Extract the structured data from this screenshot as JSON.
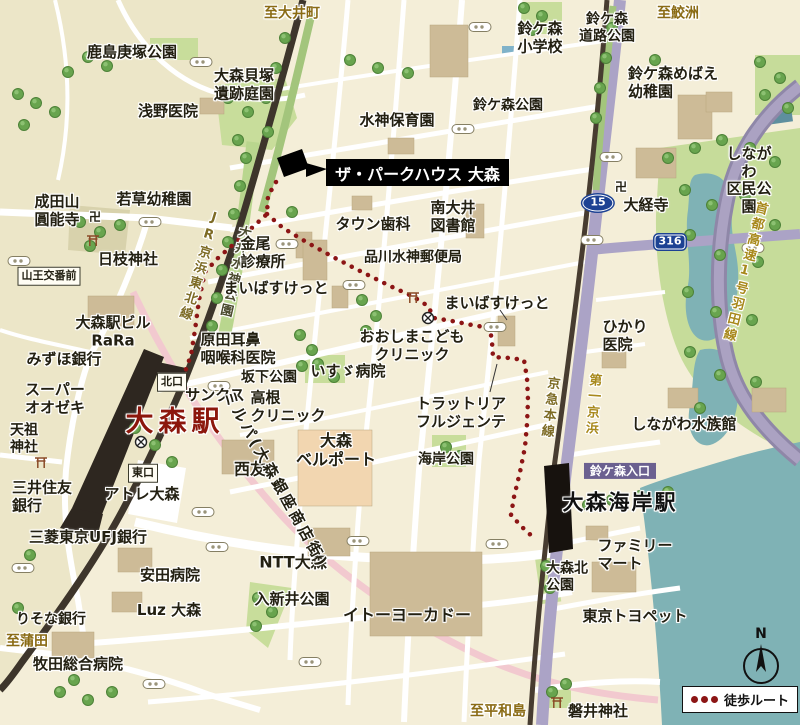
{
  "callout": {
    "text": "ザ・パークハウス 大森"
  },
  "legend": {
    "label": "徒歩ルート"
  },
  "compass": {
    "north": "N"
  },
  "colors": {
    "route_red": "#8C1515",
    "rail": "#3D352B",
    "road_purple": "#ABA3C6",
    "water": "#7FB2B5",
    "park_green": "#C8DD9B",
    "background": "#F4EED8",
    "property_black": "#000000",
    "station_red": "#8C170C"
  },
  "labels": [
    {
      "n": "dir-oimachi",
      "t": "至大井町",
      "x": 292,
      "y": 14,
      "c": "brown"
    },
    {
      "n": "kashima-kozuka-park",
      "t": "鹿島庚塚公園",
      "x": 132,
      "y": 53,
      "c": "s15"
    },
    {
      "n": "omori-kaizuka-garden",
      "t": "大森貝塚\n遺跡庭園",
      "x": 244,
      "y": 85,
      "c": "s15"
    },
    {
      "n": "asano-clinic",
      "t": "浅野医院",
      "x": 168,
      "y": 112,
      "c": "s15"
    },
    {
      "n": "suzugamori-elementary",
      "t": "鈴ケ森\n小学校",
      "x": 540,
      "y": 38,
      "c": "s15"
    },
    {
      "n": "suzugamori-road-park",
      "t": "鈴ケ森\n道路公園",
      "x": 607,
      "y": 28,
      "c": "s14"
    },
    {
      "n": "dir-samezu",
      "t": "至鮫洲",
      "x": 678,
      "y": 14,
      "c": "brown"
    },
    {
      "n": "suzugamori-park",
      "t": "鈴ケ森公園",
      "x": 508,
      "y": 106,
      "c": "s14"
    },
    {
      "n": "suijin-nursery",
      "t": "水神保育園",
      "x": 397,
      "y": 121,
      "c": "s15"
    },
    {
      "n": "suzugamori-mebae-kindergarten",
      "t": "鈴ケ森めばえ\n幼稚園",
      "x": 673,
      "y": 83,
      "c": "left s15"
    },
    {
      "n": "shinagawa-kumin-park",
      "t": "しながわ\n区民公園",
      "x": 749,
      "y": 181,
      "c": "s15"
    },
    {
      "n": "manji-daikyoji-icon",
      "t": "卍",
      "x": 621,
      "y": 187,
      "c": "s12"
    },
    {
      "n": "daikyoji-temple",
      "t": "大経寺",
      "x": 646,
      "y": 206,
      "c": "s15"
    },
    {
      "n": "route-15-shield",
      "t": "15",
      "x": 598,
      "y": 203,
      "c": "shield15"
    },
    {
      "n": "route-316-shield",
      "t": "316",
      "x": 670,
      "y": 242,
      "c": "shield316"
    },
    {
      "n": "shuto-expressway",
      "t": "首都高速1号羽田線",
      "x": 744,
      "y": 272,
      "c": "vert gold",
      "r": 14
    },
    {
      "n": "naritasan-ennoji",
      "t": "成田山\n圓能寺",
      "x": 57,
      "y": 211,
      "c": "s15"
    },
    {
      "n": "manji-ennoji-icon",
      "t": "卍",
      "x": 95,
      "y": 217,
      "c": "s12"
    },
    {
      "n": "wakakusa-kindergarten",
      "t": "若草幼稚園",
      "x": 154,
      "y": 200,
      "c": "s15"
    },
    {
      "n": "hie-shrine",
      "t": "日枝神社",
      "x": 128,
      "y": 260,
      "c": "s15"
    },
    {
      "n": "sanno-koban-mae",
      "t": "山王交番前",
      "x": 49,
      "y": 276,
      "c": "badge"
    },
    {
      "n": "jr-keihin-tohoku-line",
      "t": "JR京浜東北線",
      "x": 199,
      "y": 266,
      "c": "vert gold2",
      "r": 17
    },
    {
      "n": "oi-suijin-park",
      "t": "大井水神公園",
      "x": 234,
      "y": 272,
      "c": "vert darkv",
      "r": 13
    },
    {
      "n": "kanao-clinic",
      "t": "金尾\n診療所",
      "x": 263,
      "y": 253,
      "c": "left s15"
    },
    {
      "n": "maibasuketto-west",
      "t": "まいばすけっと",
      "x": 276,
      "y": 289,
      "c": "s15"
    },
    {
      "n": "harada-ent-clinic",
      "t": "原田耳鼻\n咽喉科医院",
      "x": 238,
      "y": 349,
      "c": "left s15"
    },
    {
      "n": "omori-station-bldg-rara",
      "t": "大森駅ビル\nRaRa",
      "x": 113,
      "y": 332,
      "c": "s15"
    },
    {
      "n": "mizuho-bank",
      "t": "みずほ銀行",
      "x": 64,
      "y": 360,
      "c": "s15"
    },
    {
      "n": "super-ozeki",
      "t": "スーパー\nオオゼキ",
      "x": 55,
      "y": 399,
      "c": "left s15"
    },
    {
      "n": "tenso-shrine",
      "t": "天祖\n神社",
      "x": 24,
      "y": 439,
      "c": "left s14"
    },
    {
      "n": "north-exit-badge",
      "t": "北口",
      "x": 172,
      "y": 382,
      "c": "badge"
    },
    {
      "n": "sunkus",
      "t": "サンクス",
      "x": 215,
      "y": 396,
      "c": "s15"
    },
    {
      "n": "omori-station",
      "t": "大森駅",
      "x": 175,
      "y": 421,
      "c": "red-sta"
    },
    {
      "n": "east-exit-badge",
      "t": "東口",
      "x": 143,
      "y": 473,
      "c": "badge"
    },
    {
      "n": "atre-omori",
      "t": "アトレ大森",
      "x": 142,
      "y": 495,
      "c": "s15"
    },
    {
      "n": "sakashita-park",
      "t": "坂下公園",
      "x": 269,
      "y": 378,
      "c": "s14"
    },
    {
      "n": "takane-clinic",
      "t": "高根\nクリニック",
      "x": 288,
      "y": 407,
      "c": "left s15"
    },
    {
      "n": "isuzu-hospital",
      "t": "いすゞ病院",
      "x": 348,
      "y": 372,
      "c": "s15"
    },
    {
      "n": "oshima-kids-clinic",
      "t": "おおしまこども\nクリニック",
      "x": 412,
      "y": 346,
      "c": "s15"
    },
    {
      "n": "seiyu",
      "t": "西友",
      "x": 250,
      "y": 470,
      "c": "s16"
    },
    {
      "n": "omori-bellport",
      "t": "大森\nベルポート",
      "x": 336,
      "y": 451,
      "c": "s16"
    },
    {
      "n": "town-dental",
      "t": "タウン歯科",
      "x": 373,
      "y": 225,
      "c": "s15"
    },
    {
      "n": "minami-oi-library",
      "t": "南大井\n図書館",
      "x": 453,
      "y": 217,
      "c": "s15"
    },
    {
      "n": "shinagawa-suijin-post-office",
      "t": "品川水神郵便局",
      "x": 413,
      "y": 258,
      "c": "s14"
    },
    {
      "n": "maibasuketto-east",
      "t": "まいばすけっと",
      "x": 497,
      "y": 304,
      "c": "s15"
    },
    {
      "n": "trattoria-fulgente",
      "t": "トラットリア\nフルジェンテ",
      "x": 461,
      "y": 413,
      "c": "s15"
    },
    {
      "n": "kaigan-park",
      "t": "海岸公園",
      "x": 446,
      "y": 460,
      "c": "s14"
    },
    {
      "n": "keikyu-main-line",
      "t": "京急本線",
      "x": 549,
      "y": 408,
      "c": "vert gold2",
      "r": 7
    },
    {
      "n": "daiichi-keihin",
      "t": "第一京浜",
      "x": 592,
      "y": 405,
      "c": "vert gold",
      "r": 4
    },
    {
      "n": "hikari-clinic",
      "t": "ひかり\n医院",
      "x": 625,
      "y": 336,
      "c": "left s15"
    },
    {
      "n": "shinagawa-aquarium",
      "t": "しながわ水族館",
      "x": 684,
      "y": 425,
      "c": "s15"
    },
    {
      "n": "suzugamori-entrance-badge",
      "t": "鈴ケ森入口",
      "x": 620,
      "y": 471,
      "c": "pbadge"
    },
    {
      "n": "omorikaigan-station",
      "t": "大森海岸駅",
      "x": 620,
      "y": 503,
      "c": "blk-sta"
    },
    {
      "n": "family-mart",
      "t": "ファミリー\nマート",
      "x": 635,
      "y": 555,
      "c": "left s15"
    },
    {
      "n": "omorikita-park",
      "t": "大森北\n公園",
      "x": 567,
      "y": 577,
      "c": "left s14"
    },
    {
      "n": "tokyo-toyopet",
      "t": "東京トヨペット",
      "x": 635,
      "y": 617,
      "c": "s15"
    },
    {
      "n": "iwai-shrine",
      "t": "磐井神社",
      "x": 598,
      "y": 712,
      "c": "s15"
    },
    {
      "n": "dir-heiwajima",
      "t": "至平和島",
      "x": 498,
      "y": 712,
      "c": "brown"
    },
    {
      "n": "ito-yokado",
      "t": "イトーヨーカドー",
      "x": 407,
      "y": 616,
      "c": "s16"
    },
    {
      "n": "ntt-omori",
      "t": "NTT大森",
      "x": 293,
      "y": 563,
      "c": "s16"
    },
    {
      "n": "iriarai-park",
      "t": "入新井公園",
      "x": 292,
      "y": 600,
      "c": "s15"
    },
    {
      "n": "yasuda-hospital",
      "t": "安田病院",
      "x": 170,
      "y": 576,
      "c": "s15"
    },
    {
      "n": "luz-omori",
      "t": "Luz 大森",
      "x": 169,
      "y": 611,
      "c": "s15"
    },
    {
      "n": "smbc-bank",
      "t": "三井住友\n銀行",
      "x": 42,
      "y": 497,
      "c": "left s15"
    },
    {
      "n": "mufg-bank",
      "t": "三菱東京UFJ銀行",
      "x": 88,
      "y": 538,
      "c": "s15"
    },
    {
      "n": "risona-bank",
      "t": "りそな銀行",
      "x": 51,
      "y": 620,
      "c": "s14"
    },
    {
      "n": "dir-kamata",
      "t": "至蒲田",
      "x": 27,
      "y": 642,
      "c": "brown"
    },
    {
      "n": "makita-general-hospital",
      "t": "牧田総合病院",
      "x": 78,
      "y": 665,
      "c": "s15"
    },
    {
      "n": "milpa-shopping-street",
      "t": "ミルパ(大森銀座商店街)",
      "x": 275,
      "y": 480,
      "c": "milpa",
      "r": 61
    }
  ]
}
